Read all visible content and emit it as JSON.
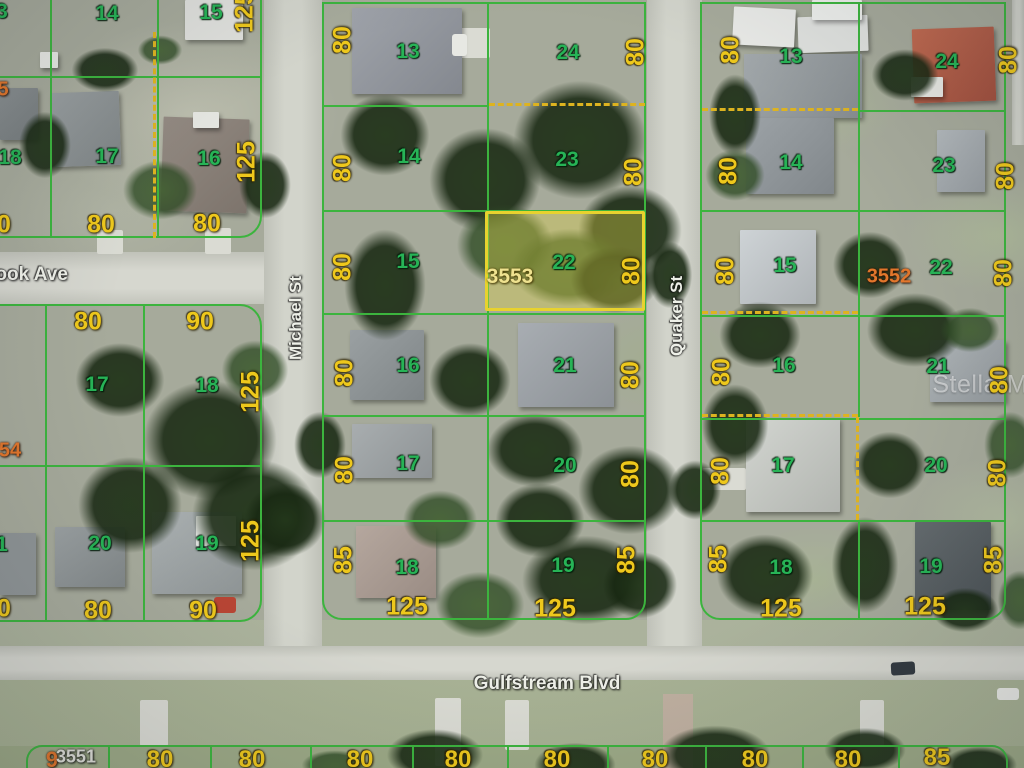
{
  "map": {
    "watermark": "StellarMLS",
    "subject_parcel": {
      "id": "3553",
      "lot_number": "22",
      "frontage_label": "80"
    },
    "other_parcel_ids": [
      "3552",
      "3551"
    ],
    "streets": {
      "vertical_west": "Michael St",
      "vertical_east": "Quaker St",
      "avenue_partial": "rook Ave",
      "boulevard": "Gulfstream Blvd"
    },
    "colors": {
      "lot_number": "#27b356",
      "dimension": "#eec81c",
      "parcel_id": "#e2762c",
      "street_name": "#eef0e8",
      "boundary_line": "#3cb43e",
      "easement_dash": "#ddb320",
      "highlight_border": "#e8d22e"
    },
    "labels": [
      {
        "t": "3",
        "x": 2,
        "y": 12,
        "c": "lot"
      },
      {
        "t": "14",
        "x": 107,
        "y": 14,
        "c": "lot"
      },
      {
        "t": "15",
        "x": 211,
        "y": 13,
        "c": "lot"
      },
      {
        "t": "125",
        "x": 245,
        "y": 12,
        "c": "dim",
        "r": -90
      },
      {
        "t": "5",
        "x": 3,
        "y": 90,
        "c": "addr"
      },
      {
        "t": "17",
        "x": 107,
        "y": 157,
        "c": "lot"
      },
      {
        "t": "16",
        "x": 209,
        "y": 159,
        "c": "lot"
      },
      {
        "t": "125",
        "x": 247,
        "y": 162,
        "c": "dim",
        "r": -90
      },
      {
        "t": "18",
        "x": 10,
        "y": 158,
        "c": "lot"
      },
      {
        "t": "80",
        "x": 101,
        "y": 225,
        "c": "dim"
      },
      {
        "t": "80",
        "x": 207,
        "y": 224,
        "c": "dim"
      },
      {
        "t": "0",
        "x": 4,
        "y": 225,
        "c": "dim"
      },
      {
        "t": "80",
        "x": 88,
        "y": 322,
        "c": "dim"
      },
      {
        "t": "90",
        "x": 200,
        "y": 322,
        "c": "dim"
      },
      {
        "t": "17",
        "x": 97,
        "y": 385,
        "c": "lot"
      },
      {
        "t": "18",
        "x": 207,
        "y": 386,
        "c": "lot"
      },
      {
        "t": "125",
        "x": 251,
        "y": 392,
        "c": "dim",
        "r": -90
      },
      {
        "t": "54",
        "x": 10,
        "y": 451,
        "c": "addr"
      },
      {
        "t": "20",
        "x": 100,
        "y": 544,
        "c": "lot"
      },
      {
        "t": "19",
        "x": 207,
        "y": 544,
        "c": "lot"
      },
      {
        "t": "125",
        "x": 251,
        "y": 541,
        "c": "dim",
        "r": -90
      },
      {
        "t": "1",
        "x": 2,
        "y": 545,
        "c": "lot"
      },
      {
        "t": "80",
        "x": 98,
        "y": 611,
        "c": "dim"
      },
      {
        "t": "90",
        "x": 203,
        "y": 611,
        "c": "dim"
      },
      {
        "t": "0",
        "x": 4,
        "y": 609,
        "c": "dim"
      },
      {
        "t": "80",
        "x": 343,
        "y": 40,
        "c": "dim",
        "r": -90
      },
      {
        "t": "13",
        "x": 408,
        "y": 52,
        "c": "lot"
      },
      {
        "t": "24",
        "x": 568,
        "y": 53,
        "c": "lot"
      },
      {
        "t": "80",
        "x": 636,
        "y": 52,
        "c": "dim",
        "r": -90
      },
      {
        "t": "80",
        "x": 343,
        "y": 168,
        "c": "dim",
        "r": -90
      },
      {
        "t": "14",
        "x": 409,
        "y": 157,
        "c": "lot"
      },
      {
        "t": "23",
        "x": 567,
        "y": 160,
        "c": "lot"
      },
      {
        "t": "80",
        "x": 634,
        "y": 172,
        "c": "dim",
        "r": -90
      },
      {
        "t": "80",
        "x": 343,
        "y": 267,
        "c": "dim",
        "r": -90
      },
      {
        "t": "15",
        "x": 408,
        "y": 262,
        "c": "lot"
      },
      {
        "t": "3553",
        "x": 510,
        "y": 277,
        "c": "addrhl"
      },
      {
        "t": "22",
        "x": 564,
        "y": 263,
        "c": "lot"
      },
      {
        "t": "80",
        "x": 632,
        "y": 271,
        "c": "dim",
        "r": -90
      },
      {
        "t": "80",
        "x": 345,
        "y": 373,
        "c": "dim",
        "r": -90
      },
      {
        "t": "16",
        "x": 408,
        "y": 366,
        "c": "lot"
      },
      {
        "t": "21",
        "x": 565,
        "y": 366,
        "c": "lot"
      },
      {
        "t": "80",
        "x": 631,
        "y": 375,
        "c": "dim",
        "r": -90
      },
      {
        "t": "80",
        "x": 345,
        "y": 470,
        "c": "dim",
        "r": -90
      },
      {
        "t": "17",
        "x": 408,
        "y": 464,
        "c": "lot"
      },
      {
        "t": "20",
        "x": 565,
        "y": 466,
        "c": "lot"
      },
      {
        "t": "80",
        "x": 631,
        "y": 474,
        "c": "dim",
        "r": -90
      },
      {
        "t": "85",
        "x": 344,
        "y": 560,
        "c": "dim",
        "r": -90
      },
      {
        "t": "18",
        "x": 407,
        "y": 568,
        "c": "lot"
      },
      {
        "t": "19",
        "x": 563,
        "y": 566,
        "c": "lot"
      },
      {
        "t": "85",
        "x": 627,
        "y": 560,
        "c": "dim",
        "r": -90
      },
      {
        "t": "125",
        "x": 407,
        "y": 607,
        "c": "dim"
      },
      {
        "t": "125",
        "x": 555,
        "y": 609,
        "c": "dim"
      },
      {
        "t": "80",
        "x": 731,
        "y": 50,
        "c": "dim",
        "r": -90
      },
      {
        "t": "13",
        "x": 791,
        "y": 57,
        "c": "lot"
      },
      {
        "t": "24",
        "x": 947,
        "y": 62,
        "c": "lot"
      },
      {
        "t": "80",
        "x": 1009,
        "y": 60,
        "c": "dim",
        "r": -90
      },
      {
        "t": "80",
        "x": 729,
        "y": 171,
        "c": "dim",
        "r": -90
      },
      {
        "t": "14",
        "x": 791,
        "y": 163,
        "c": "lot"
      },
      {
        "t": "23",
        "x": 944,
        "y": 166,
        "c": "lot"
      },
      {
        "t": "80",
        "x": 1006,
        "y": 176,
        "c": "dim",
        "r": -90
      },
      {
        "t": "80",
        "x": 726,
        "y": 271,
        "c": "dim",
        "r": -90
      },
      {
        "t": "15",
        "x": 785,
        "y": 266,
        "c": "lot"
      },
      {
        "t": "3552",
        "x": 889,
        "y": 277,
        "c": "addr"
      },
      {
        "t": "22",
        "x": 941,
        "y": 268,
        "c": "lot"
      },
      {
        "t": "80",
        "x": 1004,
        "y": 273,
        "c": "dim",
        "r": -90
      },
      {
        "t": "80",
        "x": 722,
        "y": 372,
        "c": "dim",
        "r": -90
      },
      {
        "t": "16",
        "x": 784,
        "y": 366,
        "c": "lot"
      },
      {
        "t": "21",
        "x": 938,
        "y": 367,
        "c": "lot"
      },
      {
        "t": "80",
        "x": 1000,
        "y": 380,
        "c": "dim",
        "r": -90
      },
      {
        "t": "80",
        "x": 721,
        "y": 471,
        "c": "dim",
        "r": -90
      },
      {
        "t": "17",
        "x": 783,
        "y": 466,
        "c": "lot"
      },
      {
        "t": "20",
        "x": 936,
        "y": 466,
        "c": "lot"
      },
      {
        "t": "80",
        "x": 998,
        "y": 473,
        "c": "dim",
        "r": -90
      },
      {
        "t": "85",
        "x": 719,
        "y": 559,
        "c": "dim",
        "r": -90
      },
      {
        "t": "18",
        "x": 781,
        "y": 568,
        "c": "lot"
      },
      {
        "t": "19",
        "x": 931,
        "y": 567,
        "c": "lot"
      },
      {
        "t": "85",
        "x": 994,
        "y": 560,
        "c": "dim",
        "r": -90
      },
      {
        "t": "125",
        "x": 781,
        "y": 609,
        "c": "dim"
      },
      {
        "t": "125",
        "x": 925,
        "y": 607,
        "c": "dim"
      },
      {
        "t": "9",
        "x": 52,
        "y": 760,
        "c": "addr",
        "fs": 22
      },
      {
        "t": "3551",
        "x": 76,
        "y": 757,
        "c": "idwhite"
      },
      {
        "t": "80",
        "x": 160,
        "y": 760,
        "c": "dim",
        "fs": 24
      },
      {
        "t": "80",
        "x": 252,
        "y": 760,
        "c": "dim",
        "fs": 24
      },
      {
        "t": "80",
        "x": 360,
        "y": 760,
        "c": "dim",
        "fs": 24
      },
      {
        "t": "80",
        "x": 458,
        "y": 760,
        "c": "dim",
        "fs": 24
      },
      {
        "t": "80",
        "x": 557,
        "y": 760,
        "c": "dim",
        "fs": 24
      },
      {
        "t": "80",
        "x": 655,
        "y": 760,
        "c": "dim",
        "fs": 24
      },
      {
        "t": "80",
        "x": 755,
        "y": 760,
        "c": "dim",
        "fs": 24
      },
      {
        "t": "80",
        "x": 848,
        "y": 760,
        "c": "dim",
        "fs": 24
      },
      {
        "t": "85",
        "x": 937,
        "y": 758,
        "c": "dim",
        "fs": 24
      }
    ]
  }
}
